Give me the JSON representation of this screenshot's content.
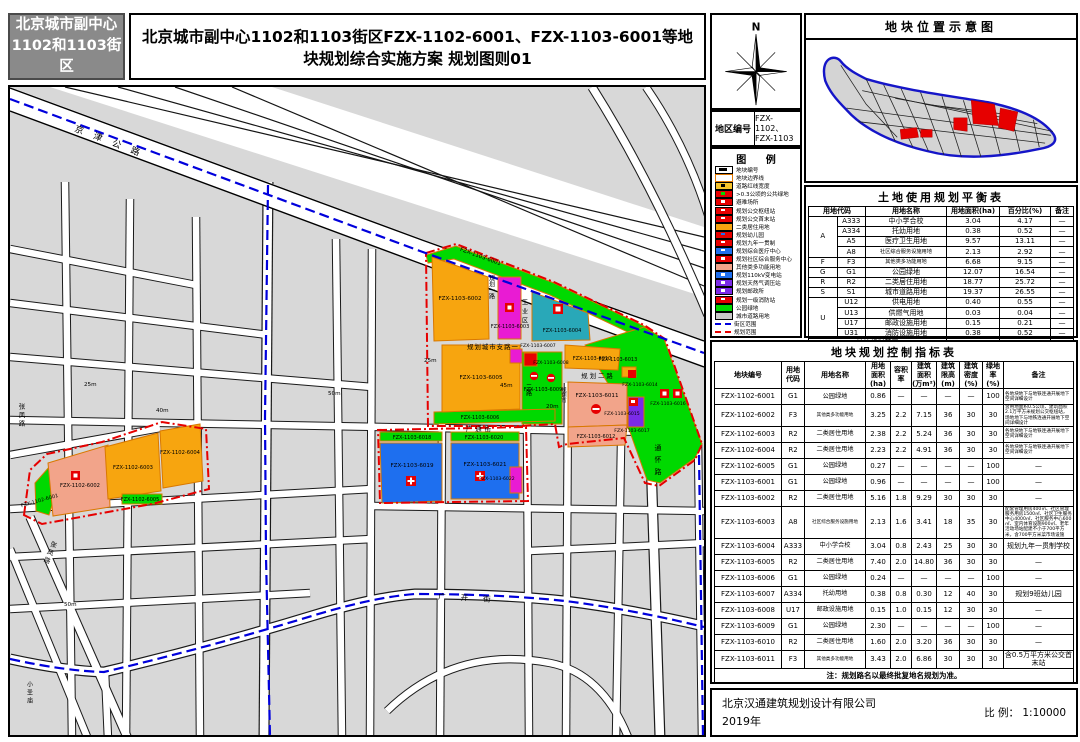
{
  "header": {
    "badge_line1": "北京城市副中心",
    "badge_line2": "1102和1103街区",
    "title": "北京城市副中心1102和1103街区FZX-1102-6001、FZX-1103-6001等地块规划综合实施方案  规划图则01"
  },
  "compass": {
    "north_label": "N"
  },
  "region_code": {
    "label": "地区编号",
    "value": "FZX-1102、\nFZX-1103"
  },
  "legend": {
    "title": "图  例",
    "items": [
      {
        "label": "地块编号",
        "chip": "c-code"
      },
      {
        "label": "地块边界线",
        "chip": "c-bound"
      },
      {
        "label": "道路红线宽度",
        "chip": "c-redline"
      },
      {
        "label": ">0.3公顷的公共绿地",
        "chip": "c-pubgreen"
      },
      {
        "label": "避难场所",
        "chip": "c-red"
      },
      {
        "label": "规划公交枢纽站",
        "chip": "c-red"
      },
      {
        "label": "规划公交首末站",
        "chip": "c-red"
      },
      {
        "label": "二类居住用地",
        "chip": "c-orange"
      },
      {
        "label": "规划幼儿园",
        "chip": "c-redblue"
      },
      {
        "label": "规划九年一贯制",
        "chip": "c-red"
      },
      {
        "label": "规划综合医疗中心",
        "chip": "c-blue"
      },
      {
        "label": "规划社区综合服务中心",
        "chip": "c-red"
      },
      {
        "label": "其他类多功能用地",
        "chip": "c-salmon"
      },
      {
        "label": "规划110kV变电站",
        "chip": "c-blue"
      },
      {
        "label": "规划天然气调压站",
        "chip": "c-purple"
      },
      {
        "label": "规划邮政所",
        "chip": "c-purple"
      },
      {
        "label": "规划一级消防站",
        "chip": "c-red"
      },
      {
        "label": "公园绿地",
        "chip": "c-green"
      },
      {
        "label": "城市道路用地",
        "chip": "c-gray"
      },
      {
        "label": "街区范围",
        "chip": "c-lineblue"
      },
      {
        "label": "规划范围",
        "chip": "c-linered"
      }
    ]
  },
  "location_map": {
    "title": "地块位置示意图"
  },
  "balance_table": {
    "title": "土地使用规划平衡表",
    "columns": [
      "用地代码",
      "用地名称",
      "用地面积(ha)",
      "百分比(%)",
      "备注"
    ],
    "rows": [
      {
        "g": "A",
        "code": "A333",
        "name": "中小学合校",
        "area": "3.04",
        "pct": "4.17",
        "note": "—"
      },
      {
        "g": "",
        "code": "A334",
        "name": "托幼用地",
        "area": "0.38",
        "pct": "0.52",
        "note": "—"
      },
      {
        "g": "",
        "code": "A5",
        "name": "医疗卫生用地",
        "area": "9.57",
        "pct": "13.11",
        "note": "—"
      },
      {
        "g": "",
        "code": "A8",
        "name": "社区综合服务设施用地",
        "area": "2.13",
        "pct": "2.92",
        "note": "—"
      },
      {
        "g": "F",
        "code": "F3",
        "name": "其他类多功能用地",
        "area": "6.68",
        "pct": "9.15",
        "note": "—"
      },
      {
        "g": "G",
        "code": "G1",
        "name": "公园绿地",
        "area": "12.07",
        "pct": "16.54",
        "note": "—"
      },
      {
        "g": "R",
        "code": "R2",
        "name": "二类居住用地",
        "area": "18.77",
        "pct": "25.72",
        "note": "—"
      },
      {
        "g": "S",
        "code": "S1",
        "name": "城市道路用地",
        "area": "19.37",
        "pct": "26.55",
        "note": "—"
      },
      {
        "g": "U",
        "code": "U12",
        "name": "供电用地",
        "area": "0.40",
        "pct": "0.55",
        "note": "—"
      },
      {
        "g": "",
        "code": "U13",
        "name": "供燃气用地",
        "area": "0.03",
        "pct": "0.04",
        "note": "—"
      },
      {
        "g": "",
        "code": "U17",
        "name": "邮政设施用地",
        "area": "0.15",
        "pct": "0.21",
        "note": "—"
      },
      {
        "g": "",
        "code": "U31",
        "name": "消防设施用地",
        "area": "0.38",
        "pct": "0.52",
        "note": "—"
      }
    ],
    "total": {
      "name": "地块规划范围",
      "area": "72.97",
      "pct": "100",
      "note": "—"
    }
  },
  "control_table": {
    "title": "地块规划控制指标表",
    "columns": [
      "地块编号",
      "用地\n代码",
      "用地名称",
      "用地\n面积\n(ha)",
      "容积\n率",
      "建筑\n面积\n(万m²)",
      "建筑\n限高\n(m)",
      "建筑\n密度\n(%)",
      "绿地\n率\n(%)",
      "备注"
    ],
    "rows": [
      [
        "FZX-1102-6001",
        "G1",
        "公园绿地",
        "0.86",
        "—",
        "—",
        "—",
        "—",
        "100",
        "各地块地下与地铁连通开展地下空间详细设计"
      ],
      [
        "FZX-1102-6002",
        "F3",
        "其他类多功能用地",
        "3.25",
        "2.2",
        "7.15",
        "36",
        "30",
        "30",
        "含用地面积0.5公顷、建筑面积2.1万平方米规划公交枢纽站，场地地下与地铁连通开展地下空间详细设计"
      ],
      [
        "FZX-1102-6003",
        "R2",
        "二类居住用地",
        "2.38",
        "2.2",
        "5.24",
        "36",
        "30",
        "30",
        "各地块地下与地铁连通开展地下空间详细设计"
      ],
      [
        "FZX-1102-6004",
        "R2",
        "二类居住用地",
        "2.23",
        "2.2",
        "4.91",
        "36",
        "30",
        "30",
        "各地块地下与地铁连通开展地下空间详细设计"
      ],
      [
        "FZX-1102-6005",
        "G1",
        "公园绿地",
        "0.27",
        "—",
        "—",
        "—",
        "—",
        "100",
        "—"
      ],
      [
        "FZX-1103-6001",
        "G1",
        "公园绿地",
        "0.96",
        "—",
        "—",
        "—",
        "—",
        "100",
        "—"
      ],
      [
        "FZX-1103-6002",
        "R2",
        "二类居住用地",
        "5.16",
        "1.8",
        "9.29",
        "30",
        "30",
        "30",
        "—"
      ],
      [
        "FZX-1103-6003",
        "A8",
        "社区综合服务设施用地",
        "2.13",
        "1.6",
        "3.41",
        "18",
        "35",
        "30",
        "配套管理用房400㎡、社区管理服务用房1500㎡、社区卫生服务中心4000㎡、社区服务中心600㎡、室内体育设施900㎡、老年活动场站配建不小于700平方米，含700平方米菜市场设施"
      ],
      [
        "FZX-1103-6004",
        "A333",
        "中小学合校",
        "3.04",
        "0.8",
        "2.43",
        "25",
        "30",
        "30",
        "规划九年一贯制学校"
      ],
      [
        "FZX-1103-6005",
        "R2",
        "二类居住用地",
        "7.40",
        "2.0",
        "14.80",
        "36",
        "30",
        "30",
        "—"
      ],
      [
        "FZX-1103-6006",
        "G1",
        "公园绿地",
        "0.24",
        "—",
        "—",
        "—",
        "—",
        "100",
        "—"
      ],
      [
        "FZX-1103-6007",
        "A334",
        "托幼用地",
        "0.38",
        "0.8",
        "0.30",
        "12",
        "40",
        "30",
        "规划9班幼儿园"
      ],
      [
        "FZX-1103-6008",
        "U17",
        "邮政设施用地",
        "0.15",
        "1.0",
        "0.15",
        "12",
        "30",
        "30",
        "—"
      ],
      [
        "FZX-1103-6009",
        "G1",
        "公园绿地",
        "2.30",
        "—",
        "—",
        "—",
        "—",
        "100",
        "—"
      ],
      [
        "FZX-1103-6010",
        "R2",
        "二类居住用地",
        "1.60",
        "2.0",
        "3.20",
        "36",
        "30",
        "30",
        "—"
      ],
      [
        "FZX-1103-6011",
        "F3",
        "其他类多功能用地",
        "3.43",
        "2.0",
        "6.86",
        "30",
        "30",
        "30",
        "含0.5万平方米公交首末站"
      ]
    ],
    "footnote": "注：规划路名以最终批复地名规划为准。"
  },
  "titleblock": {
    "company": "北京汉通建筑规划设计有限公司",
    "year": "2019年",
    "scale_label": "比  例：",
    "scale_value": "1:10000"
  },
  "map": {
    "parcels": [
      {
        "id": "FZX-1103-6001"
      },
      {
        "id": "FZX-1103-6002"
      },
      {
        "id": "FZX-1103-6003"
      },
      {
        "id": "FZX-1103-6004"
      },
      {
        "id": "FZX-1103-6005"
      },
      {
        "id": "FZX-1103-6006"
      },
      {
        "id": "FZX-1103-6007"
      },
      {
        "id": "FZX-1103-6008"
      },
      {
        "id": "FZX-1103-6009"
      },
      {
        "id": "FZX-1103-6010"
      },
      {
        "id": "FZX-1103-6011"
      },
      {
        "id": "FZX-1103-6012"
      },
      {
        "id": "FZX-1103-6013"
      },
      {
        "id": "FZX-1103-6014"
      },
      {
        "id": "FZX-1103-6015"
      },
      {
        "id": "FZX-1103-6016"
      },
      {
        "id": "FZX-1103-6017"
      },
      {
        "id": "FZX-1103-6018"
      },
      {
        "id": "FZX-1103-6019"
      },
      {
        "id": "FZX-1103-6020"
      },
      {
        "id": "FZX-1103-6021"
      },
      {
        "id": "FZX-1103-6022"
      },
      {
        "id": "FZX-1102-6001"
      },
      {
        "id": "FZX-1102-6002"
      },
      {
        "id": "FZX-1102-6003"
      },
      {
        "id": "FZX-1102-6004"
      },
      {
        "id": "FZX-1102-6005"
      }
    ],
    "roads": [
      {
        "name": "京津公路"
      },
      {
        "name": "规划城市支路一"
      },
      {
        "name": "规划一路"
      },
      {
        "name": "工业区"
      },
      {
        "name": "三路"
      },
      {
        "name": "规划二路"
      },
      {
        "name": "规划市"
      },
      {
        "name": "广通街"
      },
      {
        "name": "通怀路"
      },
      {
        "name": "张凤路"
      },
      {
        "name": "张凤路"
      },
      {
        "name": "广开街"
      },
      {
        "name": "小圣庙"
      }
    ],
    "widths": [
      "25m",
      "45m",
      "20m",
      "40m",
      "50m",
      "50m",
      "25m"
    ],
    "palette": {
      "residential_orange": "#f7a50f",
      "multifunction_salmon": "#f2a48a",
      "kindergarten_magenta": "#e91bd3",
      "school_teal": "#29a8b8",
      "medical_blue": "#1e6fef",
      "park_green": "#00d900",
      "utility_purple": "#7b2be8",
      "block_gray": "#d8d8d8",
      "boundary_red": "#e60000",
      "district_blue": "#0000dc",
      "parcel_edge_orange": "#d97800"
    }
  }
}
